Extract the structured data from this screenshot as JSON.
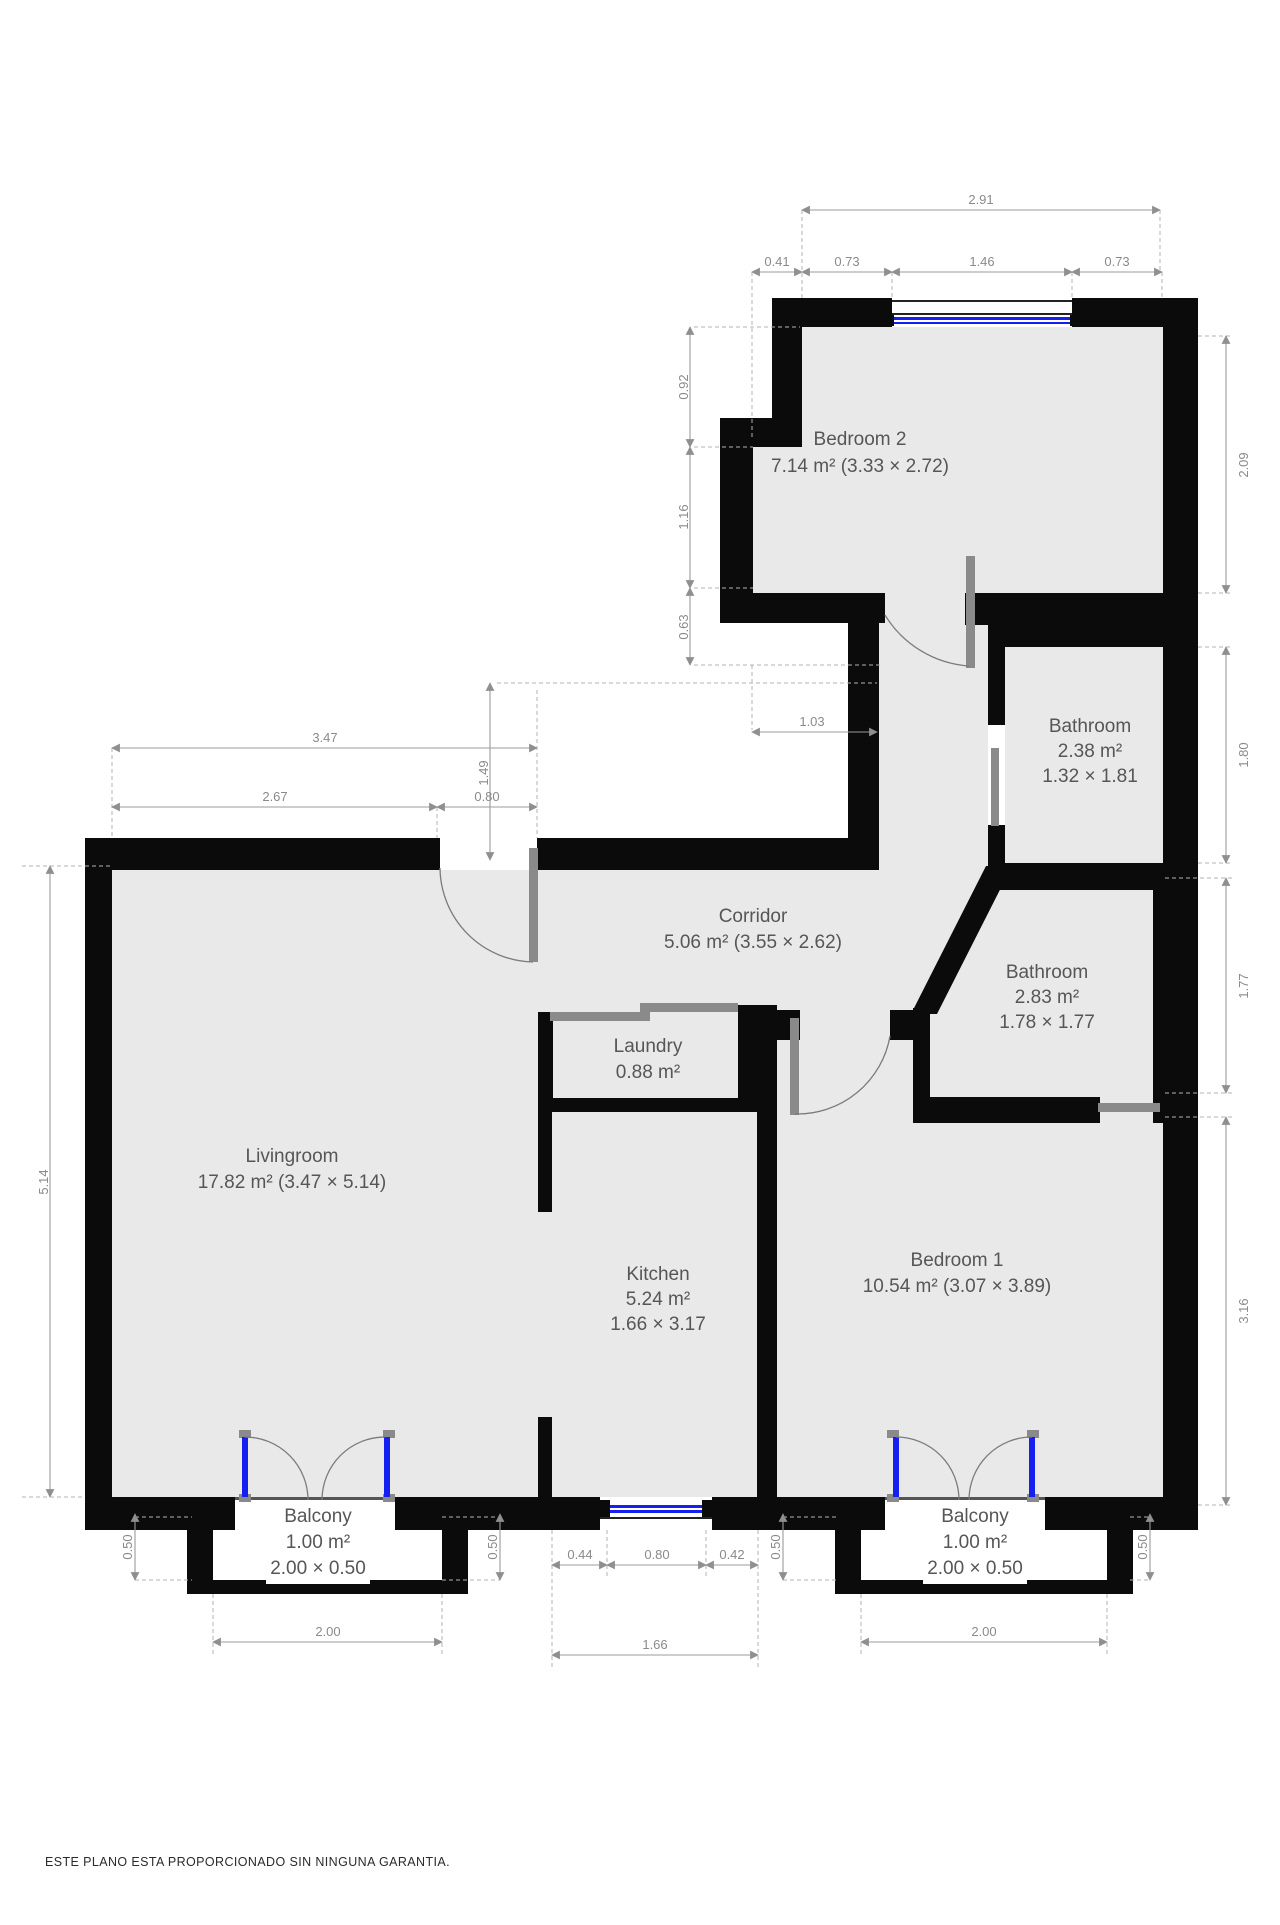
{
  "plan": {
    "colors": {
      "wall": "#0b0b0b",
      "floor": "#e9e9e9",
      "dimension": "#8a8a8a",
      "room_label": "#565656",
      "window_blue": "#1520f0",
      "door_gray": "#8a8a8a"
    },
    "rooms": [
      {
        "id": "bedroom2",
        "name": "Bedroom 2",
        "area": "7.14 m² (3.33 × 2.72)"
      },
      {
        "id": "bathroom-top",
        "name": "Bathroom",
        "area": "2.38 m²",
        "size": "1.32 × 1.81"
      },
      {
        "id": "corridor",
        "name": "Corridor",
        "area": "5.06 m² (3.55 × 2.62)"
      },
      {
        "id": "bathroom-mid",
        "name": "Bathroom",
        "area": "2.83 m²",
        "size": "1.78 × 1.77"
      },
      {
        "id": "laundry",
        "name": "Laundry",
        "area": "0.88 m²"
      },
      {
        "id": "livingroom",
        "name": "Livingroom",
        "area": "17.82 m² (3.47 × 5.14)"
      },
      {
        "id": "kitchen",
        "name": "Kitchen",
        "area": "5.24 m²",
        "size": "1.66 × 3.17"
      },
      {
        "id": "bedroom1",
        "name": "Bedroom 1",
        "area": "10.54 m² (3.07 × 3.89)"
      },
      {
        "id": "balcony-left",
        "name": "Balcony",
        "area": "1.00 m²",
        "size": "2.00 × 0.50"
      },
      {
        "id": "balcony-right",
        "name": "Balcony",
        "area": "1.00 m²",
        "size": "2.00 × 0.50"
      }
    ],
    "dims": {
      "top_total": "2.91",
      "top_a": "0.41",
      "top_b": "0.73",
      "top_c": "1.46",
      "top_d": "0.73",
      "b2_left_a": "0.92",
      "b2_left_b": "1.16",
      "b2_left_c": "0.63",
      "corridor_gap": "1.03",
      "entry_depth": "1.49",
      "lr_top_total": "3.47",
      "lr_top_a": "2.67",
      "lr_top_b": "0.80",
      "lr_left": "5.14",
      "right_a": "2.09",
      "right_b": "1.80",
      "right_c": "1.77",
      "right_d": "3.16",
      "bal_l_depth_l": "0.50",
      "bal_l_depth_r": "0.50",
      "bal_l_width": "2.00",
      "kw_a": "0.44",
      "kw_b": "0.80",
      "kw_c": "0.42",
      "kw_total": "1.66",
      "bal_r_depth_l": "0.50",
      "bal_r_depth_r": "0.50",
      "bal_r_width": "2.00"
    },
    "disclaimer": "ESTE PLANO ESTA PROPORCIONADO SIN NINGUNA GARANTIA."
  }
}
